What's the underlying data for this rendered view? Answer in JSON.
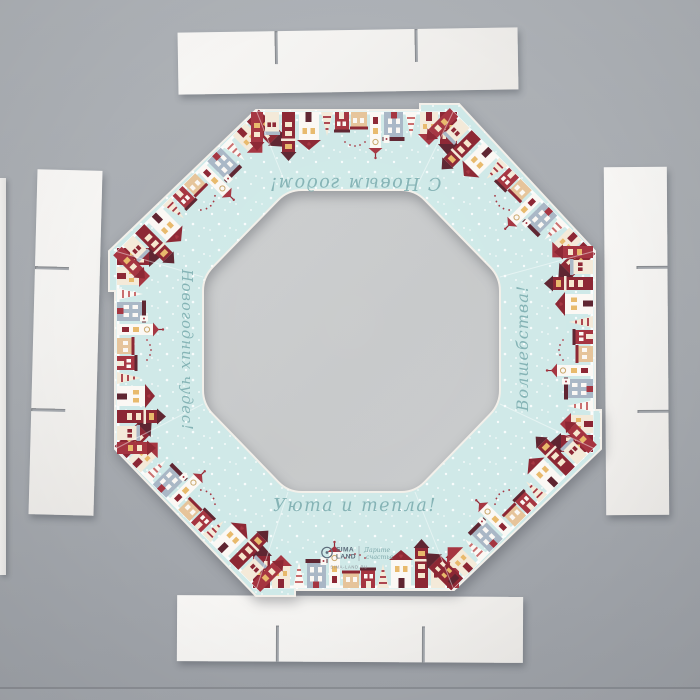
{
  "scene": {
    "description": "Flat-lay photo of an unassembled octagonal gift box blank with transparent window and four white cardboard side strips on a gray surface",
    "pieces": {
      "frame": "octagonal decorated frame blank",
      "top_strip": "white cardboard strip with two slits",
      "bottom_strip": "white cardboard strip with two slits",
      "left_strip": "white cardboard strip with two slits",
      "right_strip": "white cardboard strip with two slits"
    }
  },
  "frame_texts": {
    "top_rotated": "С Новым годом!",
    "left_rotated": "Новогодних чудес!",
    "right_rotated": "Волшебства!",
    "bottom": "Уюта и тепла!"
  },
  "logo": {
    "brand_top": "SIMA",
    "brand_bottom": "LAND",
    "slogan_line1": "Дарите",
    "slogan_line2": "счастье",
    "website": "SIMA-LAND.RU"
  },
  "colors": {
    "background_gray": "#a8acb1",
    "frame_mint": "#cfe9e8",
    "window_film_gray": "#c8cacb",
    "greeting_teal": "#7fb0b2",
    "house_maroon": "#8c2633",
    "house_red": "#a53440",
    "house_dark_roof": "#5e2430",
    "house_cream": "#f4ead9",
    "house_tan": "#e6c49a",
    "house_slate": "#a9b7c6",
    "window_amber": "#e8b96b",
    "strip_white": "#f4f3f1",
    "logo_blue_gray": "#5b6b7a"
  }
}
